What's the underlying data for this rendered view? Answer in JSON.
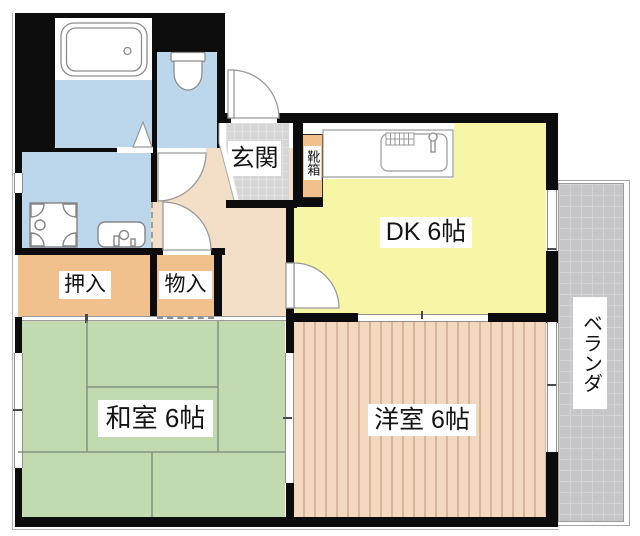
{
  "floorplan": {
    "type": "apartment-madori",
    "rooms": {
      "dk": {
        "label": "DK 6帖"
      },
      "japanese_room": {
        "label": "和室 6帖"
      },
      "western_room": {
        "label": "洋室 6帖"
      },
      "entrance": {
        "label": "玄関"
      },
      "shoe_box": {
        "label": "靴箱"
      },
      "closet_oshiire": {
        "label": "押入"
      },
      "storage_monoire": {
        "label": "物入"
      },
      "veranda": {
        "label": "ベランダ"
      }
    },
    "colors": {
      "wall": "#0c0c0c",
      "wet_rooms_blue": "#bcd6ec",
      "hallway_tan": "#f3dfc8",
      "closet_orange": "#f0c08d",
      "tatami_green": "#c1dab0",
      "dk_yellow": "#f7f6a6",
      "western_floor_pink": "#f2d8bf",
      "veranda_gray": "#c6c6c8",
      "genkan_tile_gray": "#d6d6d6"
    }
  }
}
